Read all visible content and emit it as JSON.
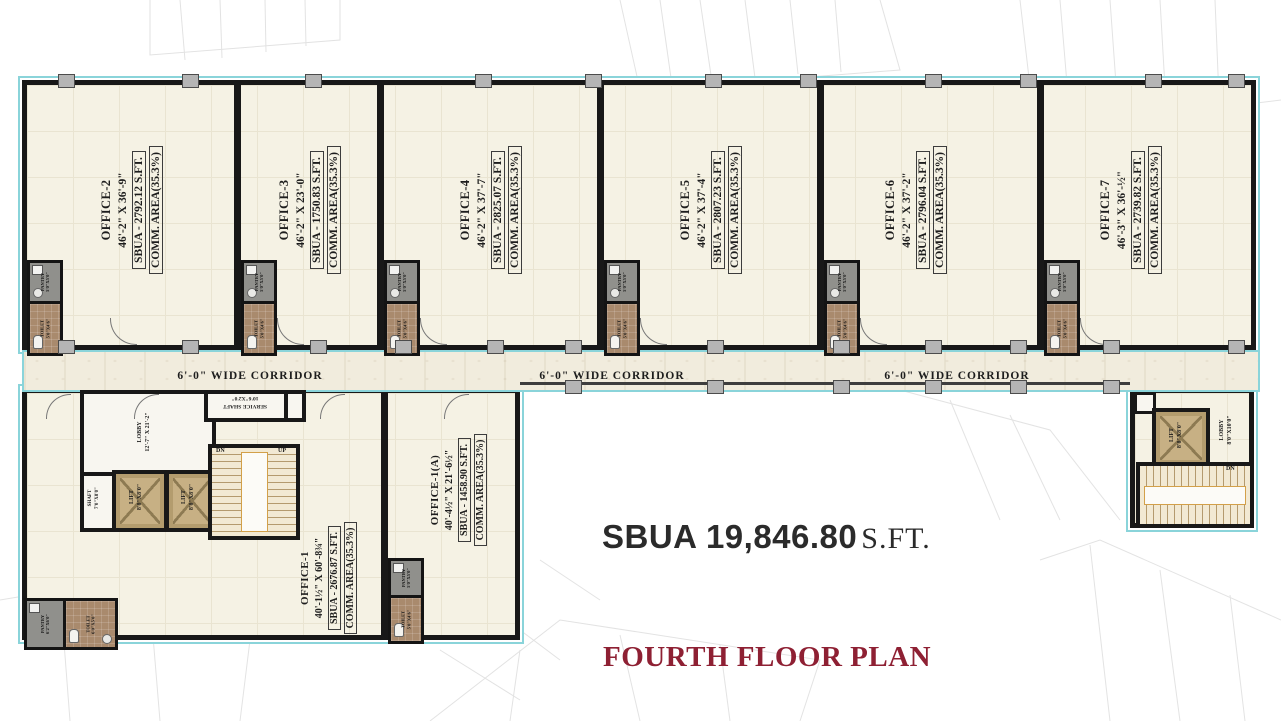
{
  "title": "FOURTH FLOOR PLAN",
  "total": {
    "sbua": "SBUA 19,846.80",
    "unit": "S.FT."
  },
  "corridor_label": "6'-0\" WIDE CORRIDOR",
  "offices": [
    {
      "name": "OFFICE-2",
      "dims": "46'-2\" X 36'-9\"",
      "sbua": "SBUA -  2792.12 S.FT.",
      "comm": "COMM. AREA(35.3%)"
    },
    {
      "name": "OFFICE-3",
      "dims": "46'-2\" X 23'-0\"",
      "sbua": "SBUA -  1750.83 S.FT.",
      "comm": "COMM. AREA(35.3%)"
    },
    {
      "name": "OFFICE-4",
      "dims": "46'-2\" X 37'-7\"",
      "sbua": "SBUA -  2825.07 S.FT.",
      "comm": "COMM. AREA(35.3%)"
    },
    {
      "name": "OFFICE-5",
      "dims": "46'-2\" X 37'-4\"",
      "sbua": "SBUA - 2807.23 S.FT.",
      "comm": "COMM. AREA(35.3%)"
    },
    {
      "name": "OFFICE-6",
      "dims": "46'-2\" X 37'-2\"",
      "sbua": "SBUA -  2796.04  S.FT.",
      "comm": "COMM. AREA(35.3%)"
    },
    {
      "name": "OFFICE-7",
      "dims": "46'-3\" X 36'-½\"",
      "sbua": "SBUA -  2739.82 S.FT.",
      "comm": "COMM. AREA(35.3%)"
    }
  ],
  "office_1": {
    "name": "OFFICE-1",
    "dims": "40'-1½\" X 60'-8¾\"",
    "sbua": "SBUA -  2676.87 S.FT.",
    "comm": "COMM. AREA(35.3%)"
  },
  "office_1a": {
    "name": "OFFICE-1(A)",
    "dims": "40'-4½\" X 21'-6½\"",
    "sbua": "SBUA -  1458.90  S.FT.",
    "comm": "COMM. AREA(35.3%)"
  },
  "rooms": {
    "pantry": {
      "label": "PANTRY",
      "size": "5'0\"X5'0\""
    },
    "toilet": {
      "label": "TOILET",
      "size": "5'0\"X4'6\""
    },
    "pantry_office1": {
      "label": "PANTRY",
      "size": "6'2\"X6'0\""
    },
    "toilet_office1": {
      "label": "TOILET",
      "size": "6'0\"X5'0\""
    },
    "lift": {
      "label": "LIFT",
      "size": "8'0\"X8'0\""
    },
    "shaft": {
      "label": "SHAFT",
      "size": "7'0\"X8'0\""
    },
    "service_shaft": {
      "label": "SERVICE SHAFT",
      "size": "10'6\"X2'0\""
    },
    "lobby_left": {
      "label": "LOBBY",
      "size": "12'-7\" X 21'-2\""
    },
    "lobby_right": {
      "label": "LOBBY",
      "size": "8'0\"X10'0\""
    },
    "up": "UP",
    "dn": "DN"
  },
  "colors": {
    "title": "#8e2033",
    "boundary": "#8ad4da",
    "wall": "#181818"
  }
}
